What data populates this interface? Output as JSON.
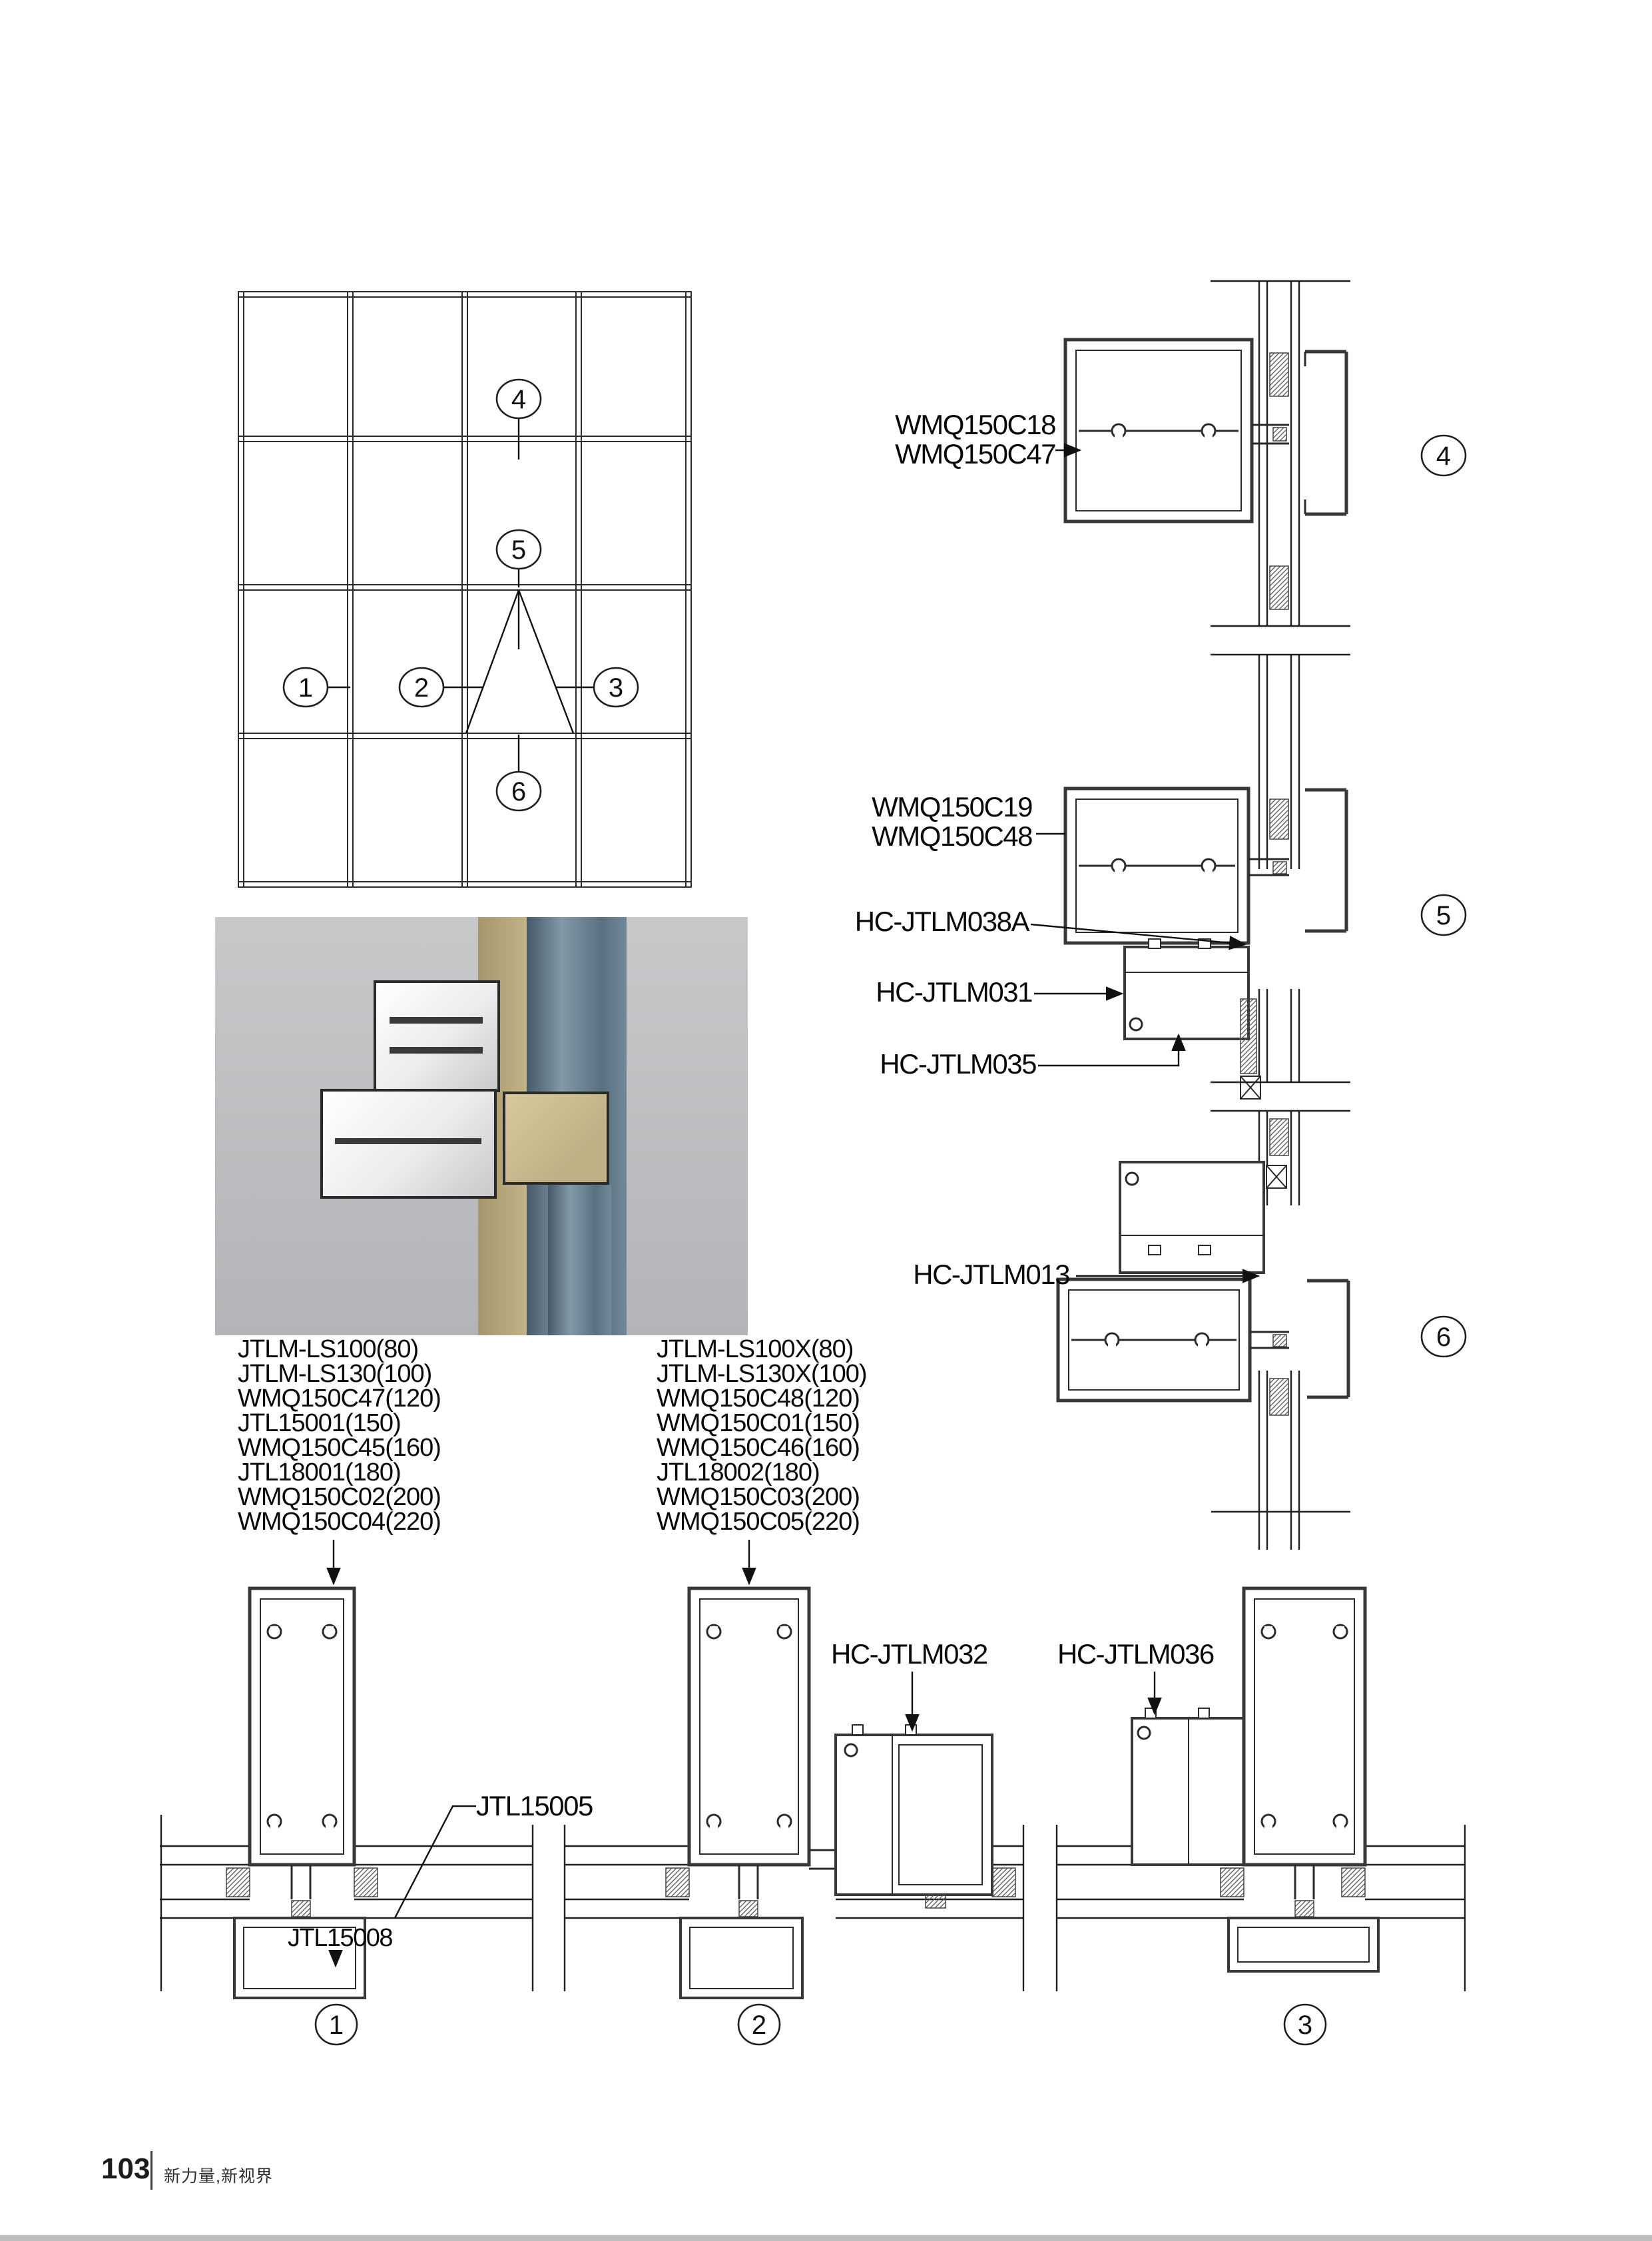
{
  "footer": {
    "page_number": "103",
    "tagline": "新力量,新视界"
  },
  "colors": {
    "line": "#2e2e2e",
    "profile_fill": "#ffffff",
    "render_bg": "#bfc0c2",
    "render_frame_tan": "#bfb184",
    "render_glass_blue": "#617687",
    "page_bg": "#ffffff"
  },
  "elevation": {
    "callouts": [
      "1",
      "2",
      "3",
      "4",
      "5",
      "6"
    ]
  },
  "sections": {
    "s4": {
      "callout": "4",
      "labels": [
        "WMQ150C18",
        "WMQ150C47"
      ]
    },
    "s5": {
      "callout": "5",
      "labels": [
        "WMQ150C19",
        "WMQ150C48"
      ],
      "extra_labels": [
        "HC-JTLM038A",
        "HC-JTLM031",
        "HC-JTLM035"
      ]
    },
    "s6": {
      "callout": "6",
      "labels": [
        "HC-JTLM013"
      ]
    },
    "s1": {
      "callout": "1",
      "labels": [
        "JTL15005",
        "JTL15008"
      ]
    },
    "s2": {
      "callout": "2",
      "labels": [
        "HC-JTLM032"
      ]
    },
    "s3": {
      "callout": "3",
      "labels": [
        "HC-JTLM036"
      ]
    }
  },
  "parts_lists": {
    "left": [
      "JTLM-LS100(80)",
      "JTLM-LS130(100)",
      "WMQ150C47(120)",
      "JTL15001(150)",
      "WMQ150C45(160)",
      "JTL18001(180)",
      "WMQ150C02(200)",
      "WMQ150C04(220)"
    ],
    "right": [
      "JTLM-LS100X(80)",
      "JTLM-LS130X(100)",
      "WMQ150C48(120)",
      "WMQ150C01(150)",
      "WMQ150C46(160)",
      "JTL18002(180)",
      "WMQ150C03(200)",
      "WMQ150C05(220)"
    ]
  }
}
